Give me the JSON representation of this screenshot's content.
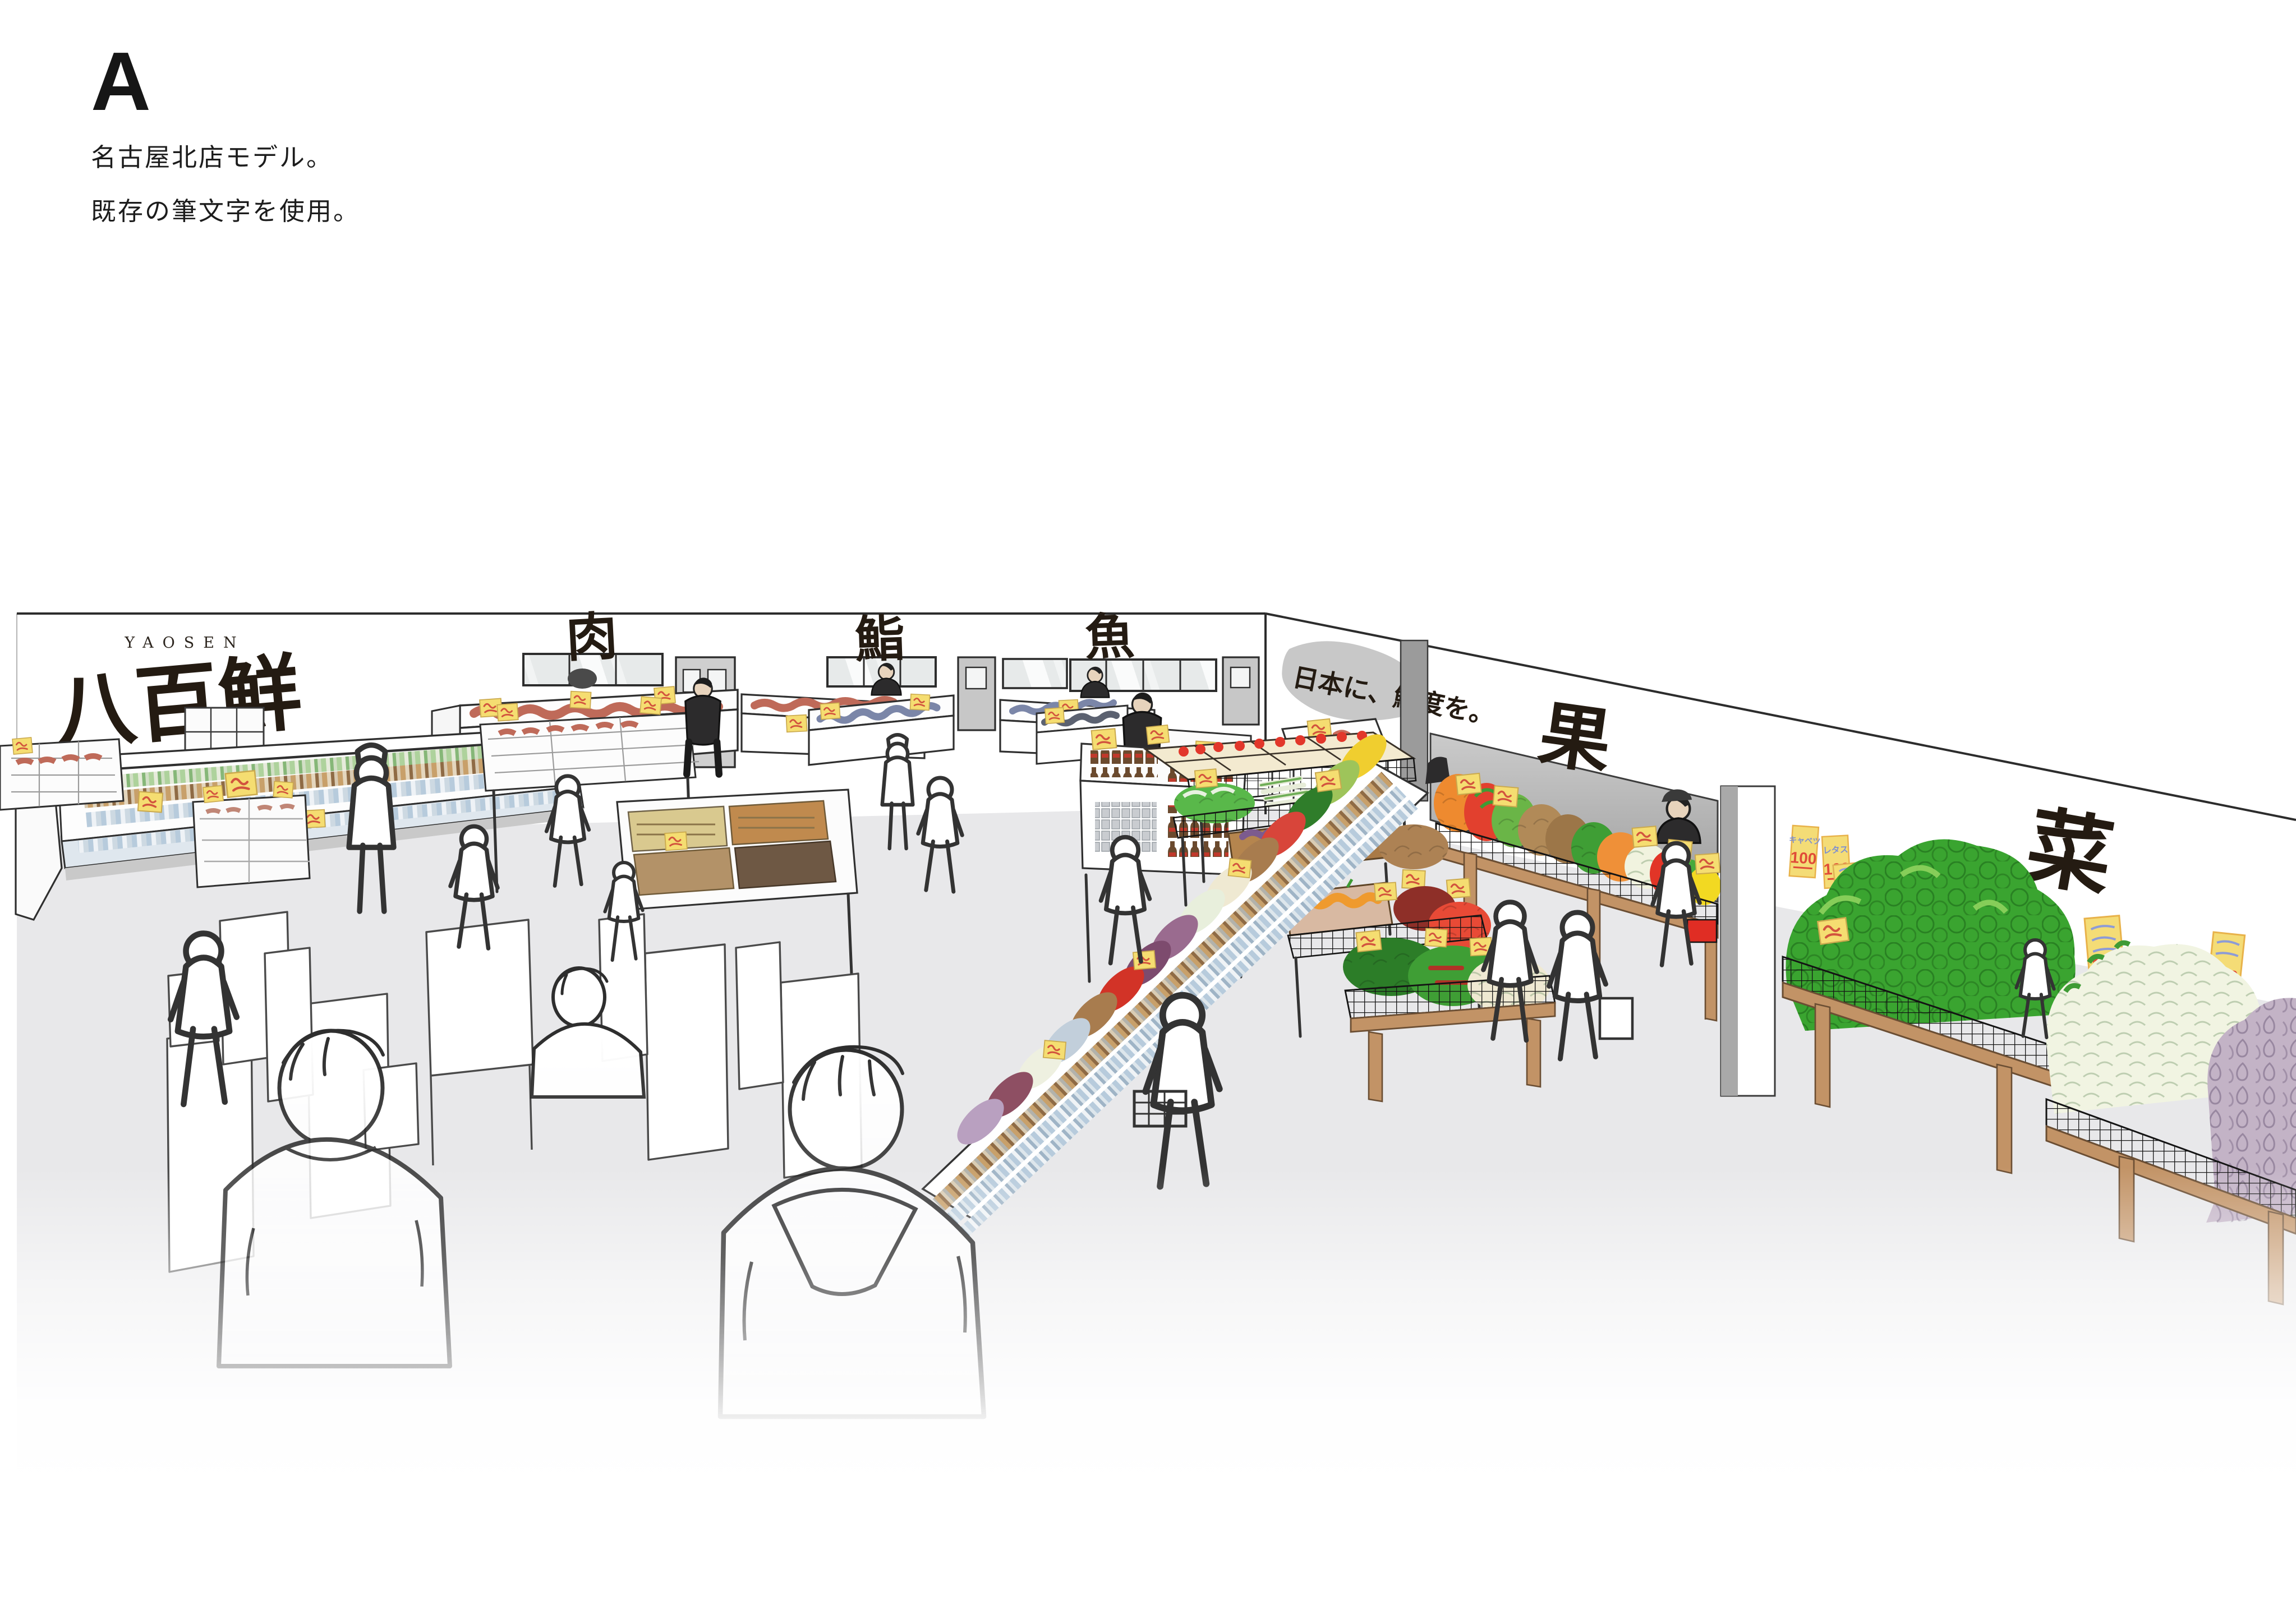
{
  "header": {
    "option_label": "A",
    "note_line1": "名古屋北店モデル。",
    "note_line2": "既存の筆文字を使用。"
  },
  "store": {
    "brand_romaji": "YAOSEN",
    "brand_kanji": "八百鮮",
    "sign_meat": "肉",
    "sign_sushi": "鮨",
    "sign_fish": "魚",
    "sign_fruit": "果",
    "sign_vegetable": "菜",
    "slogan": "日本に、鮮度を。",
    "posters": {
      "cabbage": "キャベツ",
      "lettuce": "レタス",
      "price": "100"
    },
    "colors": {
      "ink": "#2c2c2c",
      "brush_ink": "#241b12",
      "price_tag_yellow": "#f5dd71",
      "price_red": "#e04b38",
      "poster_blue": "#7d8fd0",
      "floor_gray": "#e8e8ea",
      "wall_panel_gray": "#a9a9a9",
      "wood": "#c29366",
      "mesh_black": "#141414",
      "cabbage_green": "#3aa430",
      "daikon_white": "#f1f4e2",
      "eggplant_purple": "#b5a3bd",
      "tomato_red": "#e23d2c",
      "orange": "#ef8e33",
      "lemon_yellow": "#f2d922",
      "potato_brown": "#ad8254",
      "staff_shirt": "#2c2b2c",
      "glass": "#e7eaea"
    }
  }
}
